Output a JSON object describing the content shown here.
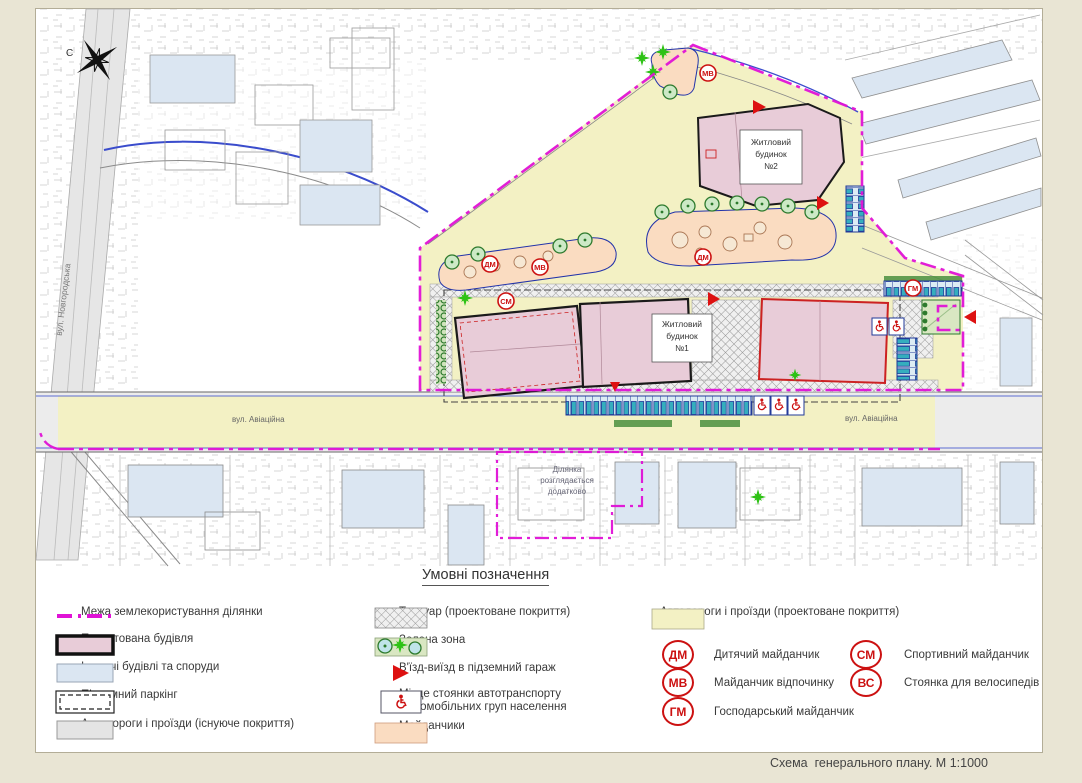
{
  "caption": "Схема  генерального плану. М 1:1000",
  "map": {
    "north": "С",
    "street_avia": "вул. Авіаційна",
    "street_novhorodska": "вул. Новгородська",
    "building1": {
      "l1": "Житловий",
      "l2": "будинок",
      "l3": "№1"
    },
    "building2": {
      "l1": "Житловий",
      "l2": "будинок",
      "l3": "№2"
    },
    "extra_plot": {
      "l1": "Ділянка",
      "l2": "розглядається",
      "l3": "додатково"
    },
    "markers": [
      {
        "code": "МВ"
      },
      {
        "code": "ДМ"
      },
      {
        "code": "МВ"
      },
      {
        "code": "ДМ"
      },
      {
        "code": "СМ"
      },
      {
        "code": "ГМ"
      }
    ]
  },
  "legend": {
    "title": "Умовні позначення",
    "col1": [
      {
        "label": "Межа землекористування ділянки"
      },
      {
        "label": "Проектована будівля"
      },
      {
        "label": "Існуючі будівлі та споруди"
      },
      {
        "label": "Підземний паркінг"
      },
      {
        "label": "Автодороги і проїзди (існуюче покриття)"
      }
    ],
    "col2": [
      {
        "label": "Тротуар (проектоване покриття)"
      },
      {
        "label": "Зелена зона"
      },
      {
        "label": "В'їзд-виїзд в підземний гараж"
      },
      {
        "line1": "Місце стоянки автотранспорту",
        "line2": "маломобільних груп населення"
      },
      {
        "label": "Майданчики"
      }
    ],
    "col3_road": {
      "label": "Автодороги і проїзди (проектоване покриття)"
    },
    "col3_codes": [
      {
        "code": "ДМ",
        "label": "Дитячий майданчик"
      },
      {
        "code": "МВ",
        "label": "Майданчик відпочинку"
      },
      {
        "code": "ГМ",
        "label": "Господарський майданчик"
      }
    ],
    "col4_codes": [
      {
        "code": "СМ",
        "label": "Спортивний майданчик"
      },
      {
        "code": "ВС",
        "label": "Стоянка для велосипедів"
      }
    ]
  },
  "colors": {
    "boundary": "#e012d6",
    "new_building": "#e8ccd8",
    "existing_building": "#dbe6f2",
    "road_existing": "#e8e8e8",
    "road_proposed": "#f3f1c4",
    "playground": "#fadcc1",
    "green_zone": "#d9e7c2",
    "symbol_red": "#cc1111",
    "parking_blue": "#223a99"
  }
}
